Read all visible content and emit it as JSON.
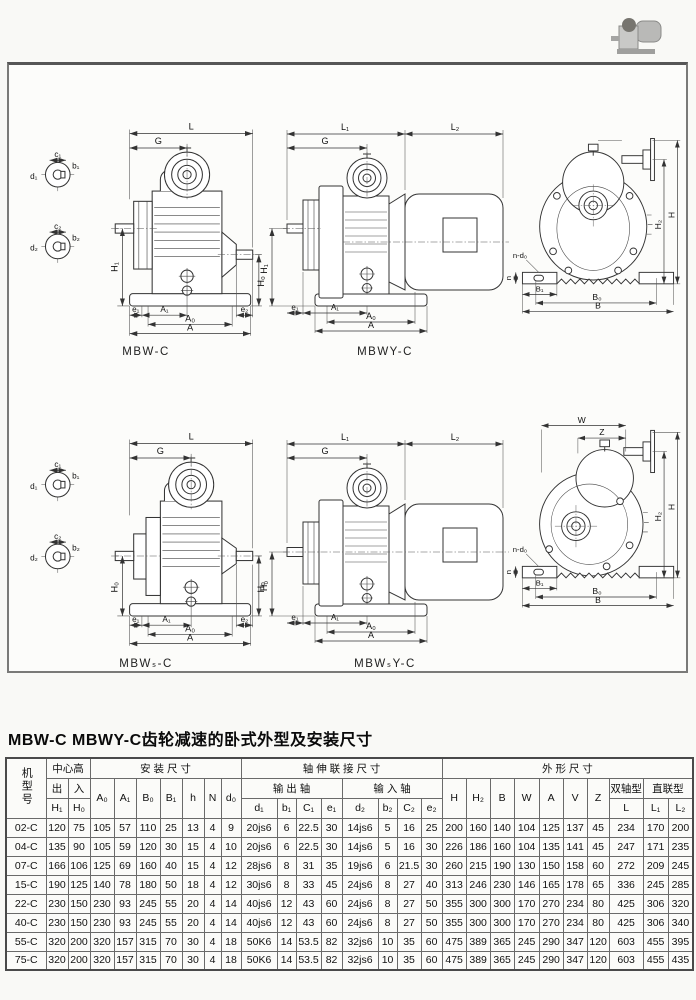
{
  "page": {
    "title": "MBW-C MBWY-C齿轮减速的卧式外型及安装尺寸"
  },
  "sym": {
    "L": "L",
    "L1": "L₁",
    "L2": "L₂",
    "G": "G",
    "H": "H",
    "H0": "H₀",
    "H1": "H₁",
    "H2": "H₂",
    "A": "A",
    "A0": "A₀",
    "A1": "A₁",
    "B": "B",
    "B0": "B₀",
    "B1": "B₁",
    "W": "W",
    "Z": "Z",
    "h": "h",
    "e1": "e₁",
    "e2": "e₂",
    "c1": "c₁",
    "c2": "c₂",
    "b1": "b₁",
    "b2": "b₂",
    "d1": "d₁",
    "d2": "d₂",
    "ndo": "n-d₀"
  },
  "figures": {
    "f1": "MBW-C",
    "f2": "MBWY-C",
    "f4": "MBWₛ-C",
    "f5": "MBWₛY-C"
  },
  "table": {
    "header": {
      "model": "机型号",
      "center_height": "中心高",
      "mounting": "安 装 尺 寸",
      "shaft_ext": "轴 伸 联 接 尺 寸",
      "outline": "外 形 尺 寸",
      "out": "出",
      "in": "入",
      "output_shaft": "输 出 轴",
      "input_shaft": "输 入 轴",
      "double_shaft": "双轴型",
      "direct": "直联型",
      "sym": {
        "H1": "H₁",
        "H0": "H₀",
        "A0": "A₀",
        "A1": "A₁",
        "B0": "B₀",
        "B1": "B₁",
        "h": "h",
        "N": "N",
        "d0": "d₀",
        "d1": "d₁",
        "b1": "b₁",
        "C1": "C₁",
        "e1": "e₁",
        "d2": "d₂",
        "b2": "b₂",
        "C2": "C₂",
        "e2": "e₂",
        "H": "H",
        "H2": "H₂",
        "B": "B",
        "W": "W",
        "A": "A",
        "V": "V",
        "Z": "Z",
        "L": "L",
        "L1": "L₁",
        "L2": "L₂"
      }
    },
    "rows": [
      [
        "02-C",
        "120",
        "75",
        "105",
        "57",
        "110",
        "25",
        "13",
        "4",
        "9",
        "20js6",
        "6",
        "22.5",
        "30",
        "14js6",
        "5",
        "16",
        "25",
        "200",
        "160",
        "140",
        "104",
        "125",
        "137",
        "45",
        "234",
        "170",
        "200"
      ],
      [
        "04-C",
        "135",
        "90",
        "105",
        "59",
        "120",
        "30",
        "15",
        "4",
        "10",
        "20js6",
        "6",
        "22.5",
        "30",
        "14js6",
        "5",
        "16",
        "30",
        "226",
        "186",
        "160",
        "104",
        "135",
        "141",
        "45",
        "247",
        "171",
        "235"
      ],
      [
        "07-C",
        "166",
        "106",
        "125",
        "69",
        "160",
        "40",
        "15",
        "4",
        "12",
        "28js6",
        "8",
        "31",
        "35",
        "19js6",
        "6",
        "21.5",
        "30",
        "260",
        "215",
        "190",
        "130",
        "150",
        "158",
        "60",
        "272",
        "209",
        "245"
      ],
      [
        "15-C",
        "190",
        "125",
        "140",
        "78",
        "180",
        "50",
        "18",
        "4",
        "12",
        "30js6",
        "8",
        "33",
        "45",
        "24js6",
        "8",
        "27",
        "40",
        "313",
        "246",
        "230",
        "146",
        "165",
        "178",
        "65",
        "336",
        "245",
        "285"
      ],
      [
        "22-C",
        "230",
        "150",
        "230",
        "93",
        "245",
        "55",
        "20",
        "4",
        "14",
        "40js6",
        "12",
        "43",
        "60",
        "24js6",
        "8",
        "27",
        "50",
        "355",
        "300",
        "300",
        "170",
        "270",
        "234",
        "80",
        "425",
        "306",
        "320"
      ],
      [
        "40-C",
        "230",
        "150",
        "230",
        "93",
        "245",
        "55",
        "20",
        "4",
        "14",
        "40js6",
        "12",
        "43",
        "60",
        "24js6",
        "8",
        "27",
        "50",
        "355",
        "300",
        "300",
        "170",
        "270",
        "234",
        "80",
        "425",
        "306",
        "340"
      ],
      [
        "55-C",
        "320",
        "200",
        "320",
        "157",
        "315",
        "70",
        "30",
        "4",
        "18",
        "50K6",
        "14",
        "53.5",
        "82",
        "32js6",
        "10",
        "35",
        "60",
        "475",
        "389",
        "365",
        "245",
        "290",
        "347",
        "120",
        "603",
        "455",
        "395"
      ],
      [
        "75-C",
        "320",
        "200",
        "320",
        "157",
        "315",
        "70",
        "30",
        "4",
        "18",
        "50K6",
        "14",
        "53.5",
        "82",
        "32js6",
        "10",
        "35",
        "60",
        "475",
        "389",
        "365",
        "245",
        "290",
        "347",
        "120",
        "603",
        "455",
        "435"
      ]
    ]
  }
}
